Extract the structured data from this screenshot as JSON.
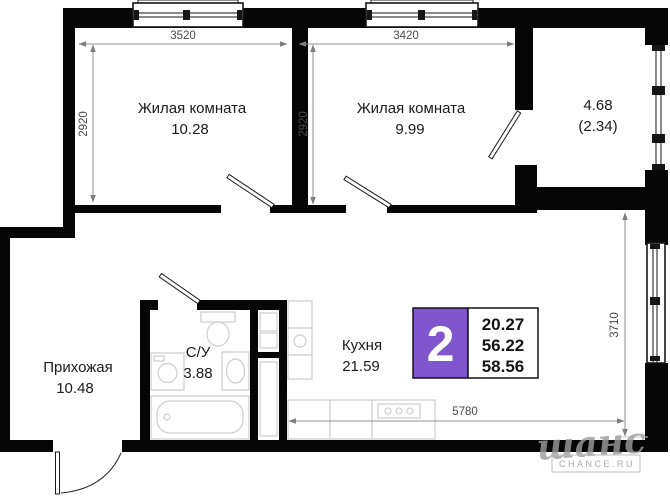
{
  "rooms": {
    "living1": {
      "label": "Жилая комната",
      "area": "10.28"
    },
    "living2": {
      "label": "Жилая комната",
      "area": "9.99"
    },
    "balcony": {
      "area": "4.68",
      "area_reduced": "(2.34)"
    },
    "hallway": {
      "label": "Прихожая",
      "area": "10.48"
    },
    "bathroom": {
      "label": "С/У",
      "area": "3.88"
    },
    "kitchen": {
      "label": "Кухня",
      "area": "21.59"
    }
  },
  "dimensions": {
    "room1_width": "3520",
    "room2_width": "3420",
    "room1_depth": "2920",
    "room2_depth": "2920",
    "kitchen_depth": "3710",
    "kitchen_width": "5780"
  },
  "badge": {
    "rooms_count": "2",
    "accent_color": "#8055cd",
    "values": [
      "20.27",
      "56.22",
      "58.56"
    ]
  },
  "watermark": {
    "logo": "шанс",
    "caption": "CHANCE.RU"
  }
}
